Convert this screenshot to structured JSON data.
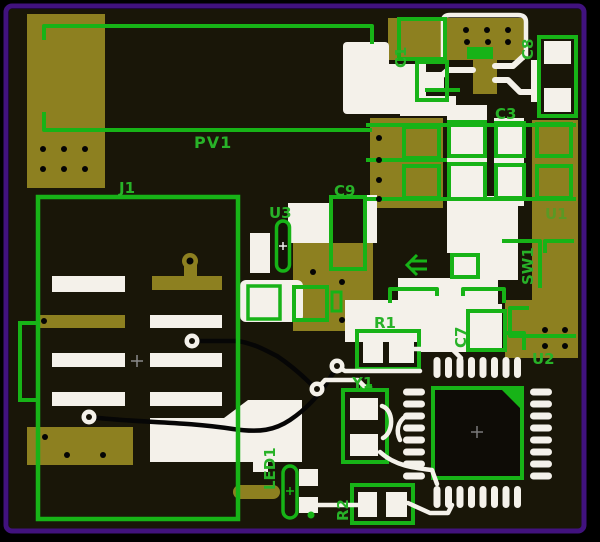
{
  "page": {
    "type": "pcb-layout-view",
    "description": "Printed circuit board layout: copper pads, silkscreen outlines and reference designators"
  },
  "palette": {
    "outer_background": "#000000",
    "board_background": "#191608",
    "copper_pad_olive": "#8d8020",
    "silkscreen_green": "#17b317",
    "bare_pad_white": "#f4f1ea",
    "frame_purple": "#41127e",
    "label_green": "#28b228",
    "bottom_trace_black": "#060606"
  },
  "labels": {
    "pv1": {
      "text": "PV1",
      "orientation": "horizontal"
    },
    "j1": {
      "text": "J1",
      "orientation": "horizontal"
    },
    "u3": {
      "text": "U3",
      "orientation": "horizontal"
    },
    "c9": {
      "text": "C9",
      "orientation": "horizontal"
    },
    "c1": {
      "text": "C1",
      "orientation": "vertical"
    },
    "c8": {
      "text": "C8",
      "orientation": "vertical"
    },
    "c3": {
      "text": "C3",
      "orientation": "horizontal"
    },
    "u1": {
      "text": "U1",
      "orientation": "horizontal"
    },
    "sw1": {
      "text": "SW1",
      "orientation": "vertical"
    },
    "r1": {
      "text": "R1",
      "orientation": "horizontal"
    },
    "c7": {
      "text": "C7",
      "orientation": "vertical"
    },
    "u2": {
      "text": "U2",
      "orientation": "horizontal"
    },
    "y1": {
      "text": "Y1",
      "orientation": "horizontal"
    },
    "led1": {
      "text": "LED1",
      "orientation": "vertical"
    },
    "r2": {
      "text": "R2",
      "orientation": "vertical"
    }
  }
}
